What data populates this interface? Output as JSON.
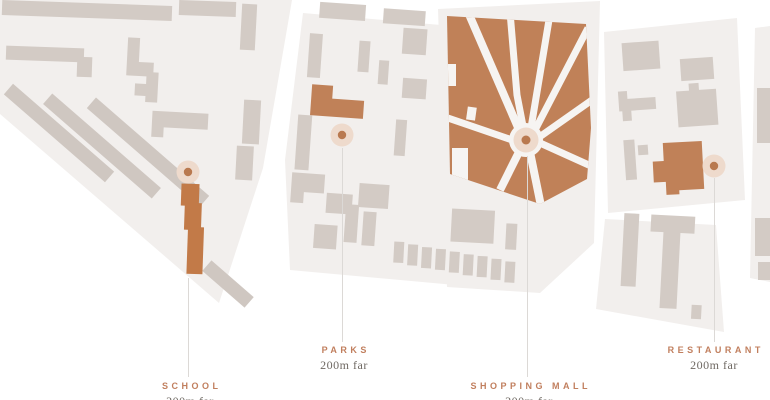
{
  "map": {
    "name": "neighborhood-amenities-map",
    "colors": {
      "background": "#ffffff",
      "block_fill": "#f2efed",
      "building_fill": "#d3cbc5",
      "accent_terracotta": "#c08158",
      "pin_halo": "#eedacc",
      "pin_dot": "#b9794f",
      "label_accent": "#c17f5e",
      "distance_text": "#6f6963",
      "connector_line": "#dcd9d6"
    },
    "locations": [
      {
        "id": "school",
        "label": "SCHOOL",
        "distance": "200m far",
        "icon": "location-pin"
      },
      {
        "id": "parks",
        "label": "PARKS",
        "distance": "200m far",
        "icon": "location-pin"
      },
      {
        "id": "shopping-mall",
        "label": "SHOPPING MALL",
        "distance": "200m far",
        "icon": "location-pin"
      },
      {
        "id": "restaurant",
        "label": "RESTAURANT",
        "distance": "200m far",
        "icon": "location-pin"
      }
    ]
  }
}
